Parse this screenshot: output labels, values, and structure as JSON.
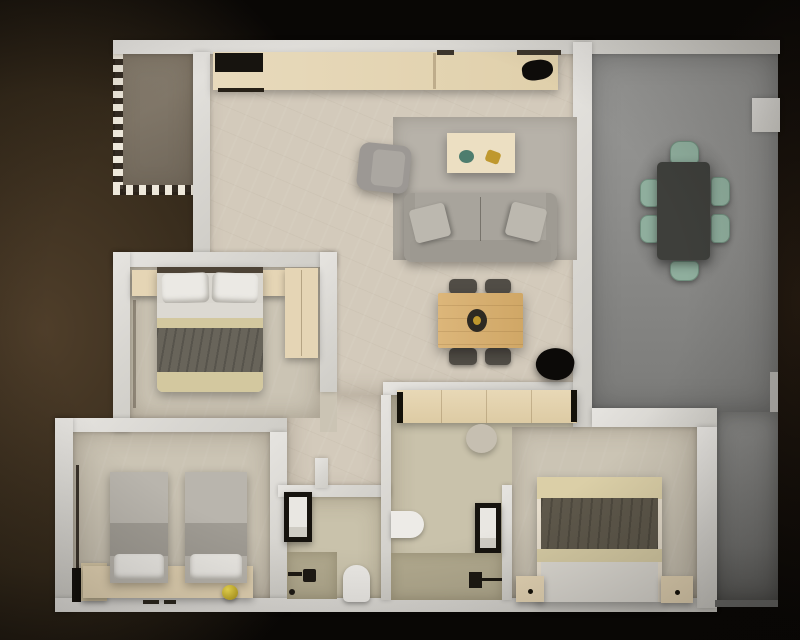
{
  "meta": {
    "description": "Top-down 3D rendered floor plan of a two-bathroom, three-bedroom apartment with balcony and side terrace on a dark brown background",
    "image_type": "3d-floor-plan-render",
    "visible_text": "none"
  },
  "palette": {
    "bg": "#090705",
    "brown_glow": "#4f3e2a",
    "wall": "#dcdad6",
    "floor_main": "#d3cabb",
    "floor_bedroom": "#cbc4b4",
    "floor_bath": "#c9c2ab",
    "vanity": "#b1a98e",
    "floor_balcony": "#7a7164",
    "floor_terrace": "#8f8f8d",
    "wood_light": "#e5d5b5",
    "wood_counter": "#e8dabc",
    "wood_table": "#d7b074",
    "sofa_gray": "#a8a49c",
    "armchair_gray": "#9c9894",
    "rug_gray": "#b7b2a9",
    "pillow_white": "#ebe9e4",
    "bed_beige": "#d3c89f",
    "throw_dark": "#68645a",
    "twin_bed_gray": "#b9b5ad",
    "teal_chair": "#8fae9d",
    "terrace_table": "#3e3f3b",
    "plant_black": "#0c0a08",
    "appliance_black": "#17140f",
    "decor_yellow": "#e8d23a",
    "decor_green": "#4e7d6e",
    "decor_gold": "#bf982e"
  },
  "rooms": {
    "balcony": {
      "name": "Balcony with railing"
    },
    "living": {
      "name": "Living room and kitchen"
    },
    "hallway": {
      "name": "Hallway to bathrooms"
    },
    "bedroom_main": {
      "name": "Bedroom with double bed"
    },
    "bedroom_twin": {
      "name": "Bedroom with twin beds"
    },
    "bedroom_back": {
      "name": "Rear bedroom with double bed"
    },
    "bathroom_left": {
      "name": "Bathroom with shower and toilet"
    },
    "bathroom_right": {
      "name": "Bathroom with shower and washbasin"
    },
    "terrace": {
      "name": "Side terrace with outdoor dining"
    }
  },
  "furniture": {
    "counter": {
      "name": "Kitchen counter"
    },
    "cooktop": {
      "name": "Cooktop"
    },
    "sink": {
      "name": "Kitchen sink"
    },
    "rug": {
      "name": "Area rug"
    },
    "sofa": {
      "name": "Three-seat sofa"
    },
    "armchair": {
      "name": "Armchair"
    },
    "coffee_table": {
      "name": "Coffee table"
    },
    "dining_table": {
      "name": "Wooden dining table with four chairs"
    },
    "plant": {
      "name": "Plant"
    },
    "terrace_table": {
      "name": "Outdoor dining table with six chairs"
    },
    "double_bed": {
      "name": "Double bed"
    },
    "twin_bed": {
      "name": "Single bed"
    },
    "bench": {
      "name": "Headboard bench"
    },
    "wardrobe": {
      "name": "Wardrobe"
    },
    "nightstand": {
      "name": "Nightstand"
    },
    "sideboard": {
      "name": "Wooden sideboard"
    },
    "shower": {
      "name": "Shower enclosure"
    },
    "toilet": {
      "name": "Toilet"
    },
    "washbasin": {
      "name": "Washbasin"
    },
    "vanity": {
      "name": "Vanity counter"
    }
  }
}
